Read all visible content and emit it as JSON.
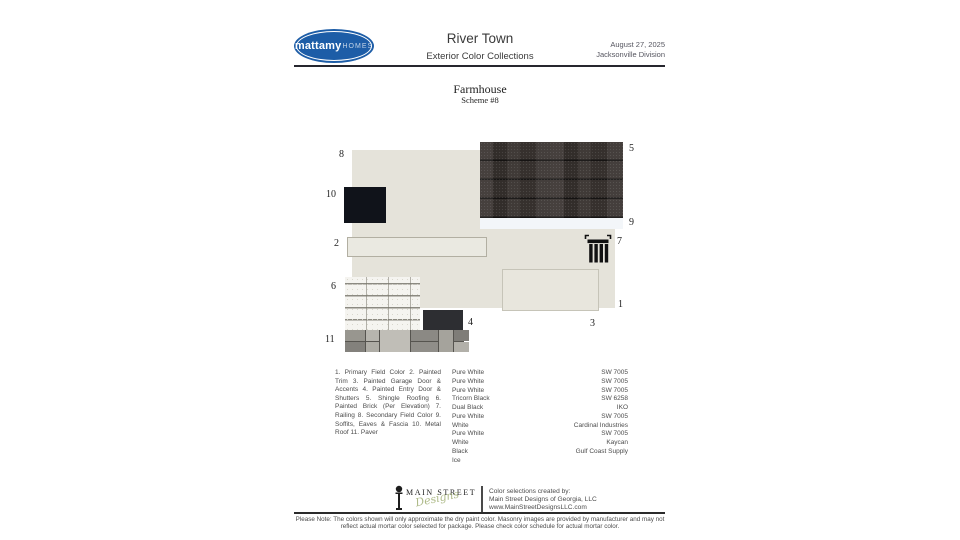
{
  "header": {
    "brand": "mattamy",
    "brand_suffix": "HOMES",
    "title": "River Town",
    "subtitle": "Exterior Color Collections",
    "date": "August 27, 2025",
    "division": "Jacksonville Division"
  },
  "scheme": {
    "style_name": "Farmhouse",
    "scheme_number": "Scheme #8"
  },
  "board": {
    "numbers": {
      "1": "1",
      "2": "2",
      "3": "3",
      "4": "4",
      "5": "5",
      "6": "6",
      "7": "7",
      "8": "8",
      "9": "9",
      "10": "10",
      "11": "11"
    }
  },
  "legend": {
    "paragraph": "1. Primary Field Color 2. Painted Trim 3. Painted Garage Door & Accents 4. Painted Entry Door & Shutters 5. Shingle Roofing 6. Painted Brick (Per Elevation) 7. Railing 8. Secondary Field Color 9. Soffits, Eaves & Fascia 10. Metal Roof 11. Paver",
    "rows": [
      {
        "color": "Pure White",
        "code": "SW 7005"
      },
      {
        "color": "Pure White",
        "code": "SW 7005"
      },
      {
        "color": "Pure White",
        "code": "SW 7005"
      },
      {
        "color": "Tricorn Black",
        "code": "SW 6258"
      },
      {
        "color": "Dual Black",
        "code": "IKO"
      },
      {
        "color": "Pure White",
        "code": "SW 7005"
      },
      {
        "color": "White",
        "code": "Cardinal Industries"
      },
      {
        "color": "Pure White",
        "code": "SW 7005"
      },
      {
        "color": "White",
        "code": "Kaycan"
      },
      {
        "color": "Black",
        "code": "Gulf Coast Supply"
      },
      {
        "color": "Ice",
        "code": ""
      }
    ]
  },
  "footer": {
    "logo_caps": "MAIN STREET",
    "logo_script": "Designs",
    "credit_intro": "Color selections created by:",
    "credit_company": "Main Street Designs of Georgia, LLC",
    "credit_website": "www.MainStreetDesignsLLC.com"
  },
  "note": "Please Note: The colors shown will only approximate the dry paint color. Masonry images are provided by manufacturer and may not reflect actual mortar color selected for package. Please check color schedule for actual mortar color.",
  "colors": {
    "brand_blue": "#1d5da7",
    "primary_field": "#e5e3da",
    "painted_trim": "#eae9e1",
    "garage_door": "#e8e6dd",
    "entry_door": "#2d2e32",
    "metal_roof": "#10131a",
    "soffit_ice": "#f3f6f9",
    "shingle_base": "#3a3431",
    "brick_white": "#f5f4f0",
    "paver_grays": [
      "#98968f",
      "#b7b5ae",
      "#8b8984",
      "#a5a39c",
      "#7f7d78",
      "#c0beb7"
    ],
    "script_green": "#a0ae74"
  }
}
